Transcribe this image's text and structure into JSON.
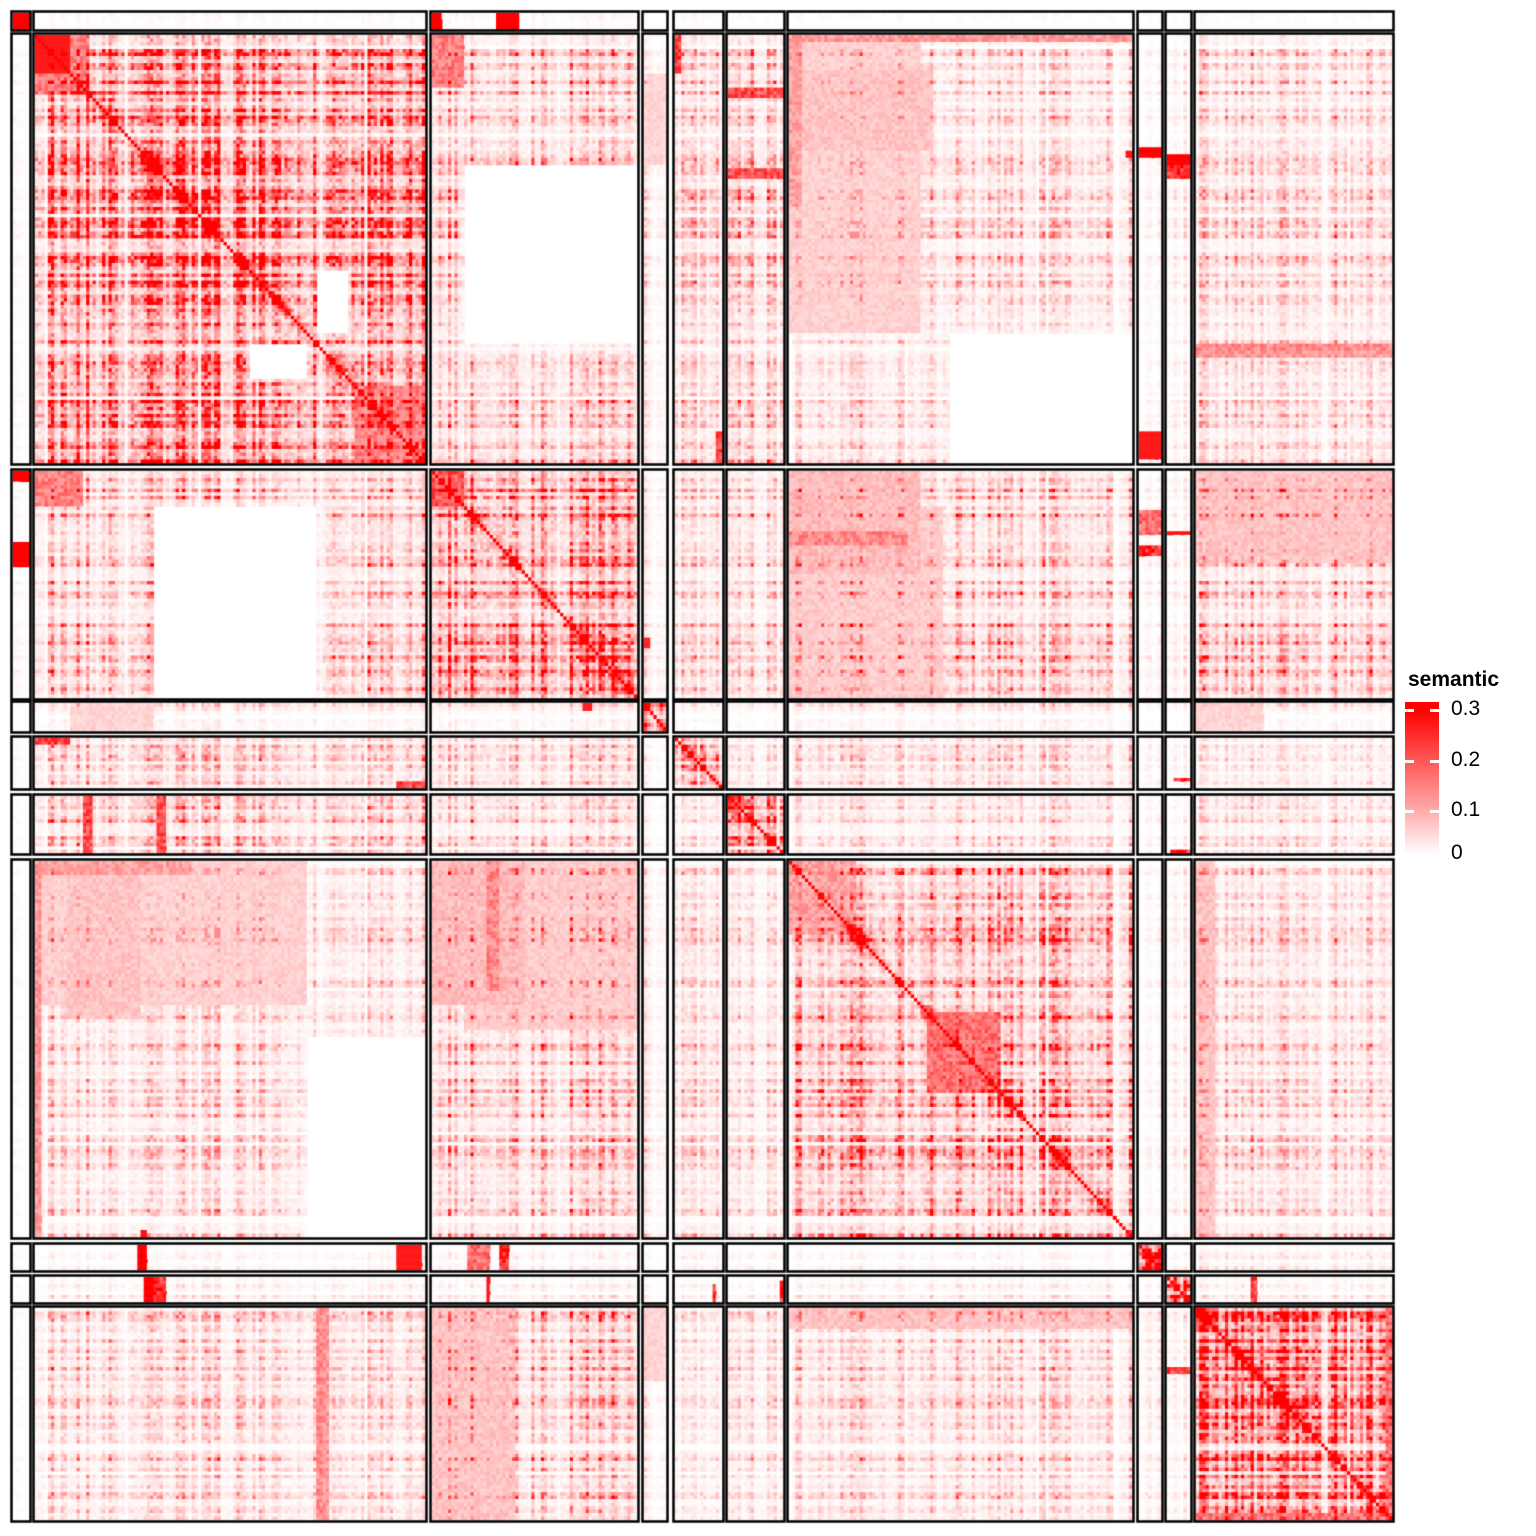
{
  "figure": {
    "width": 1536,
    "height": 1536,
    "background": "#ffffff",
    "border_color": "#000000"
  },
  "legend": {
    "title": "semantic",
    "color_high": "#FF0000",
    "color_mid2": "#FF5555",
    "color_mid1": "#FFAAAA",
    "color_low": "#FFFFFF",
    "bar": {
      "x": 6,
      "y": 34,
      "w": 34,
      "h": 152
    },
    "ticks": [
      {
        "label": "0.3",
        "frac": 0.055
      },
      {
        "label": "0.2",
        "frac": 0.385
      },
      {
        "label": "0.1",
        "frac": 0.715
      },
      {
        "label": "0",
        "frac": 1.0
      }
    ]
  },
  "chart_data": {
    "type": "heatmap",
    "value_name": "semantic",
    "value_range": [
      0,
      0.3
    ],
    "diagonal_value": 0.3,
    "n_clusters": 10,
    "cluster_sizes": [
      5,
      122,
      64,
      7,
      15,
      17,
      107,
      7,
      7,
      61
    ],
    "col_blocks_px": [
      [
        13,
        16
      ],
      [
        35,
        390
      ],
      [
        432,
        205
      ],
      [
        644,
        22
      ],
      [
        675,
        47
      ],
      [
        728,
        55
      ],
      [
        789,
        343
      ],
      [
        1139,
        22
      ],
      [
        1167,
        23
      ],
      [
        1196,
        196
      ]
    ],
    "row_blocks_px": [
      [
        13,
        16
      ],
      [
        35,
        428
      ],
      [
        471,
        227
      ],
      [
        703,
        28
      ],
      [
        738,
        50
      ],
      [
        796,
        57
      ],
      [
        861,
        376
      ],
      [
        1245,
        25
      ],
      [
        1277,
        25
      ],
      [
        1308,
        212
      ]
    ],
    "block_means": [
      [
        0.3,
        0.003,
        0.004,
        0.002,
        0.002,
        0.002,
        0.002,
        0.002,
        0.002,
        0.002
      ],
      [
        0.003,
        0.12,
        0.048,
        0.018,
        0.032,
        0.042,
        0.03,
        0.006,
        0.012,
        0.032
      ],
      [
        0.004,
        0.048,
        0.105,
        0.018,
        0.028,
        0.032,
        0.045,
        0.008,
        0.012,
        0.048
      ],
      [
        0.002,
        0.018,
        0.018,
        0.23,
        0.008,
        0.008,
        0.018,
        0.004,
        0.006,
        0.015
      ],
      [
        0.002,
        0.032,
        0.028,
        0.008,
        0.042,
        0.015,
        0.025,
        0.006,
        0.006,
        0.015
      ],
      [
        0.002,
        0.042,
        0.032,
        0.008,
        0.015,
        0.085,
        0.022,
        0.006,
        0.006,
        0.022
      ],
      [
        0.002,
        0.03,
        0.045,
        0.018,
        0.025,
        0.022,
        0.072,
        0.006,
        0.012,
        0.032
      ],
      [
        0.002,
        0.006,
        0.008,
        0.004,
        0.006,
        0.006,
        0.006,
        0.2,
        0.006,
        0.012
      ],
      [
        0.002,
        0.012,
        0.012,
        0.006,
        0.006,
        0.006,
        0.012,
        0.006,
        0.265,
        0.012
      ],
      [
        0.002,
        0.032,
        0.048,
        0.015,
        0.015,
        0.022,
        0.032,
        0.012,
        0.012,
        0.14
      ]
    ],
    "features": [
      {
        "r": 0,
        "c": 0,
        "rows": [
          0,
          1
        ],
        "cols": [
          0,
          1
        ],
        "v": 0.3
      },
      {
        "r": 0,
        "c": 2,
        "rows": [
          0,
          1
        ],
        "cols": [
          0,
          0.05
        ],
        "v": 0.3
      },
      {
        "r": 0,
        "c": 2,
        "rows": [
          0,
          1
        ],
        "cols": [
          0.32,
          0.42
        ],
        "v": 0.3
      },
      {
        "r": 1,
        "c": 1,
        "rows": [
          0,
          0.09
        ],
        "cols": [
          0,
          0.09
        ],
        "v": 0.27
      },
      {
        "r": 1,
        "c": 1,
        "rows": [
          0,
          0.14
        ],
        "cols": [
          0,
          0.14
        ],
        "v": 0.15
      },
      {
        "r": 1,
        "c": 1,
        "rows": [
          0.82,
          1
        ],
        "cols": [
          0.82,
          1
        ],
        "v": 0.15
      },
      {
        "r": 1,
        "c": 1,
        "rows": [
          0.72,
          0.8
        ],
        "cols": [
          0.55,
          0.7
        ],
        "v": -1
      },
      {
        "r": 1,
        "c": 1,
        "rows": [
          0.55,
          0.7
        ],
        "cols": [
          0.72,
          0.8
        ],
        "v": -1
      },
      {
        "r": 1,
        "c": 2,
        "rows": [
          0,
          0.12
        ],
        "cols": [
          0,
          0.15
        ],
        "v": 0.15
      },
      {
        "r": 1,
        "c": 5,
        "rows": [
          0.125,
          0.142
        ],
        "cols": [
          0,
          1
        ],
        "v": 0.19
      },
      {
        "r": 1,
        "c": 5,
        "rows": [
          0.315,
          0.332
        ],
        "cols": [
          0,
          1
        ],
        "v": 0.19
      },
      {
        "r": 1,
        "c": 6,
        "rows": [
          0,
          0.015
        ],
        "cols": [
          0,
          1
        ],
        "v": 0.12
      },
      {
        "r": 1,
        "c": 6,
        "rows": [
          0,
          0.4
        ],
        "cols": [
          0,
          0.04
        ],
        "v": 0.11
      },
      {
        "r": 1,
        "c": 6,
        "rows": [
          0.08,
          0.27
        ],
        "cols": [
          0,
          0.42
        ],
        "v": 0.07
      },
      {
        "r": 1,
        "c": 6,
        "rows": [
          0.7,
          1
        ],
        "cols": [
          0.47,
          1
        ],
        "v": -1
      },
      {
        "r": 1,
        "c": 6,
        "rows": [
          0.27,
          0.288
        ],
        "cols": [
          0.985,
          1
        ],
        "v": 0.28
      },
      {
        "r": 1,
        "c": 7,
        "rows": [
          0.27,
          0.288
        ],
        "cols": [
          0,
          1
        ],
        "v": 0.28
      },
      {
        "r": 1,
        "c": 8,
        "rows": [
          0.29,
          0.335
        ],
        "cols": [
          0,
          1
        ],
        "v": 0.24
      },
      {
        "r": 1,
        "c": 9,
        "rows": [
          0.72,
          0.75
        ],
        "cols": [
          0,
          1
        ],
        "v": 0.12
      },
      {
        "r": 2,
        "c": 1,
        "rows": [
          0.15,
          1
        ],
        "cols": [
          0.3,
          0.72
        ],
        "v": -1
      },
      {
        "r": 2,
        "c": 2,
        "rows": [
          0,
          0.15
        ],
        "cols": [
          0,
          0.15
        ],
        "v": 0.2
      },
      {
        "r": 2,
        "c": 3,
        "rows": [
          0.74,
          0.78
        ],
        "cols": [
          0,
          0.35
        ],
        "v": 0.26
      },
      {
        "r": 2,
        "c": 6,
        "rows": [
          0,
          0.45
        ],
        "cols": [
          0,
          0.38
        ],
        "v": 0.08
      },
      {
        "r": 2,
        "c": 6,
        "rows": [
          0.27,
          0.33
        ],
        "cols": [
          0,
          0.35
        ],
        "v": 0.14
      },
      {
        "r": 2,
        "c": 7,
        "rows": [
          0.33,
          0.37
        ],
        "cols": [
          0,
          1
        ],
        "v": 0.24
      },
      {
        "r": 2,
        "c": 9,
        "rows": [
          0,
          0.4
        ],
        "cols": [
          0,
          1
        ],
        "v": 0.07
      },
      {
        "r": 3,
        "c": 1,
        "rows": [
          0,
          1
        ],
        "cols": [
          0.09,
          0.3
        ],
        "v": 0.05
      },
      {
        "r": 3,
        "c": 9,
        "rows": [
          0,
          1
        ],
        "cols": [
          0,
          0.35
        ],
        "v": 0.05
      },
      {
        "r": 4,
        "c": 1,
        "rows": [
          0,
          0.12
        ],
        "cols": [
          0,
          0.09
        ],
        "v": 0.22
      },
      {
        "r": 4,
        "c": 1,
        "rows": [
          0.88,
          1
        ],
        "cols": [
          0.93,
          1
        ],
        "v": 0.22
      },
      {
        "r": 4,
        "c": 8,
        "rows": [
          0.78,
          0.84
        ],
        "cols": [
          0.35,
          1
        ],
        "v": 0.25
      },
      {
        "r": 5,
        "c": 1,
        "rows": [
          0,
          1
        ],
        "cols": [
          0.125,
          0.145
        ],
        "v": 0.2
      },
      {
        "r": 5,
        "c": 1,
        "rows": [
          0,
          1
        ],
        "cols": [
          0.315,
          0.335
        ],
        "v": 0.2
      },
      {
        "r": 5,
        "c": 5,
        "rows": [
          0,
          0.3
        ],
        "cols": [
          0,
          0.3
        ],
        "v": 0.14
      },
      {
        "r": 5,
        "c": 8,
        "rows": [
          0.92,
          1
        ],
        "cols": [
          0.1,
          1
        ],
        "v": 0.25
      },
      {
        "r": 6,
        "c": 1,
        "rows": [
          0,
          0.38
        ],
        "cols": [
          0,
          0.7
        ],
        "v": 0.055
      },
      {
        "r": 6,
        "c": 2,
        "rows": [
          0,
          0.45
        ],
        "cols": [
          0.15,
          1
        ],
        "v": 0.06
      },
      {
        "r": 6,
        "c": 6,
        "rows": [
          0.4,
          0.62
        ],
        "cols": [
          0.4,
          0.62
        ],
        "v": 0.17
      },
      {
        "r": 6,
        "c": 6,
        "rows": [
          0,
          0.2
        ],
        "cols": [
          0,
          0.2
        ],
        "v": 0.11
      },
      {
        "r": 7,
        "c": 1,
        "rows": [
          0,
          1
        ],
        "cols": [
          0.26,
          0.285
        ],
        "v": 0.3
      },
      {
        "r": 7,
        "c": 1,
        "rows": [
          0,
          1
        ],
        "cols": [
          0.93,
          0.995
        ],
        "v": 0.27
      },
      {
        "r": 7,
        "c": 2,
        "rows": [
          0,
          1
        ],
        "cols": [
          0.17,
          0.28
        ],
        "v": 0.17
      },
      {
        "r": 8,
        "c": 1,
        "rows": [
          0,
          1
        ],
        "cols": [
          0.28,
          0.3
        ],
        "v": 0.3
      },
      {
        "r": 8,
        "c": 2,
        "rows": [
          0,
          1
        ],
        "cols": [
          0.26,
          0.28
        ],
        "v": 0.28
      },
      {
        "r": 8,
        "c": 9,
        "rows": [
          0,
          1
        ],
        "cols": [
          0.28,
          0.31
        ],
        "v": 0.22
      },
      {
        "r": 9,
        "c": 1,
        "rows": [
          0,
          1
        ],
        "cols": [
          0.72,
          0.74
        ],
        "v": 0.14
      },
      {
        "r": 9,
        "c": 6,
        "rows": [
          0,
          0.1
        ],
        "cols": [
          0,
          1
        ],
        "v": 0.07
      },
      {
        "r": 9,
        "c": 9,
        "rows": [
          0.96,
          1
        ],
        "cols": [
          0,
          1
        ],
        "v": 0.17
      },
      {
        "r": 9,
        "c": 9,
        "rows": [
          0,
          1
        ],
        "cols": [
          0.97,
          1
        ],
        "v": 0.17
      },
      {
        "r": 9,
        "c": 9,
        "rows": [
          0,
          0.12
        ],
        "cols": [
          0,
          0.12
        ],
        "v": 0.17
      }
    ]
  }
}
